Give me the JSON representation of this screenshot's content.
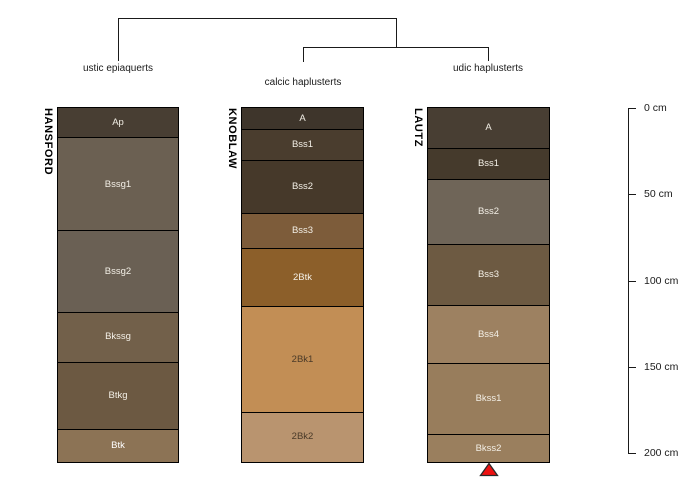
{
  "figure": {
    "background": "#FFFFFF",
    "line_color": "#1A1A1A"
  },
  "chart_data": {
    "type": "bar",
    "subtype": "soil-profile-sketches-with-dendrogram",
    "depth_axis": {
      "unit": "cm",
      "range_cm": [
        0,
        200
      ],
      "ticks": [
        {
          "value": 0,
          "label": "0 cm"
        },
        {
          "value": 50,
          "label": "50 cm"
        },
        {
          "value": 100,
          "label": "100 cm"
        },
        {
          "value": 150,
          "label": "150 cm"
        },
        {
          "value": 200,
          "label": "200 cm"
        }
      ]
    },
    "dendrogram": {
      "structure": "(HANSFORD,(KNOBLAW,LAUTZ))",
      "leaves": [
        {
          "profile": "HANSFORD",
          "taxon_label": "ustic epiaquerts"
        },
        {
          "profile": "KNOBLAW",
          "taxon_label": "calcic haplusterts"
        },
        {
          "profile": "LAUTZ",
          "taxon_label": "udic haplusterts"
        }
      ]
    },
    "profiles": [
      {
        "id": "HANSFORD",
        "horizons": [
          {
            "name": "Ap",
            "top_cm": 0,
            "bottom_cm": 17,
            "color": "#483E33",
            "label_color": "#F3EFE6"
          },
          {
            "name": "Bssg1",
            "top_cm": 17,
            "bottom_cm": 71,
            "color": "#6B6052",
            "label_color": "#F3EFE6"
          },
          {
            "name": "Bssg2",
            "top_cm": 71,
            "bottom_cm": 118,
            "color": "#6A6054",
            "label_color": "#F3EFE6"
          },
          {
            "name": "Bkssg",
            "top_cm": 118,
            "bottom_cm": 147,
            "color": "#72604A",
            "label_color": "#F3EFE6"
          },
          {
            "name": "Btkg",
            "top_cm": 147,
            "bottom_cm": 186,
            "color": "#6C5942",
            "label_color": "#F3EFE6"
          },
          {
            "name": "Btk",
            "top_cm": 186,
            "bottom_cm": 205,
            "color": "#8C7355",
            "label_color": "#FFFFFF"
          }
        ]
      },
      {
        "id": "KNOBLAW",
        "horizons": [
          {
            "name": "A",
            "top_cm": 0,
            "bottom_cm": 12,
            "color": "#3E352B",
            "label_color": "#F3EFE6"
          },
          {
            "name": "Bss1",
            "top_cm": 12,
            "bottom_cm": 30,
            "color": "#4A3D2E",
            "label_color": "#F3EFE6"
          },
          {
            "name": "Bss2",
            "top_cm": 30,
            "bottom_cm": 61,
            "color": "#46392A",
            "label_color": "#F3EFE6"
          },
          {
            "name": "Bss3",
            "top_cm": 61,
            "bottom_cm": 81,
            "color": "#7D5C3A",
            "label_color": "#F3EFE6"
          },
          {
            "name": "2Btk",
            "top_cm": 81,
            "bottom_cm": 115,
            "color": "#8C5F2A",
            "label_color": "#F3EFE6"
          },
          {
            "name": "2Bk1",
            "top_cm": 115,
            "bottom_cm": 176,
            "color": "#C28E55",
            "label_color": "#4A3A28"
          },
          {
            "name": "2Bk2",
            "top_cm": 176,
            "bottom_cm": 205,
            "color": "#B9946F",
            "label_color": "#4A3A28"
          }
        ]
      },
      {
        "id": "LAUTZ",
        "horizons": [
          {
            "name": "A",
            "top_cm": 0,
            "bottom_cm": 23,
            "color": "#483E33",
            "label_color": "#F3EFE6"
          },
          {
            "name": "Bss1",
            "top_cm": 23,
            "bottom_cm": 41,
            "color": "#453A2C",
            "label_color": "#F3EFE6"
          },
          {
            "name": "Bss2",
            "top_cm": 41,
            "bottom_cm": 79,
            "color": "#6F6558",
            "label_color": "#F3EFE6"
          },
          {
            "name": "Bss3",
            "top_cm": 79,
            "bottom_cm": 114,
            "color": "#6D5A42",
            "label_color": "#F3EFE6"
          },
          {
            "name": "Bss4",
            "top_cm": 114,
            "bottom_cm": 148,
            "color": "#9D8161",
            "label_color": "#F3EFE6"
          },
          {
            "name": "Bkss1",
            "top_cm": 148,
            "bottom_cm": 189,
            "color": "#987D5C",
            "label_color": "#F3EFE6"
          },
          {
            "name": "Bkss2",
            "top_cm": 189,
            "bottom_cm": 205,
            "color": "#9A7F5E",
            "label_color": "#F3EFE6"
          }
        ]
      }
    ],
    "marker": {
      "shape": "filled-triangle-up",
      "fill": "#EE1111",
      "stroke": "#2A2A2A",
      "below_profile": "LAUTZ"
    }
  }
}
